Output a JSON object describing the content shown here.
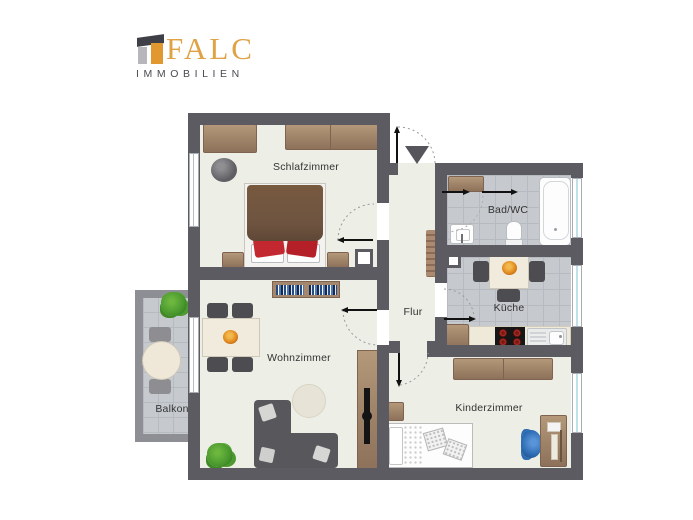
{
  "brand": {
    "name": "FALC",
    "subtitle": "IMMOBILIEN",
    "name_color": "#dfa245",
    "subtitle_color": "#4a4a52"
  },
  "rooms": {
    "schlafzimmer": {
      "label": "Schlafzimmer"
    },
    "badwc": {
      "label": "Bad/WC"
    },
    "kueche": {
      "label": "Küche"
    },
    "flur": {
      "label": "Flur"
    },
    "wohnzimmer": {
      "label": "Wohnzimmer"
    },
    "balkon": {
      "label": "Balkon"
    },
    "kinderzimmer": {
      "label": "Kinderzimmer"
    }
  },
  "icons": {
    "entrance_arrow": "entrance-direction-arrow",
    "door_swings": "dotted quarter-circle door swing arcs",
    "sliding_door_arrows": "sliding-door direction arrows"
  },
  "colors": {
    "wall": "#5b5b61",
    "balcony_wall": "#8e8f94",
    "room_floor": "#edeee5",
    "tile_floor": "#c6cace",
    "furniture_brown": "#b49879",
    "bed_duvet": "#6e5440",
    "accent_red": "#c32830",
    "sofa_gray": "#58585c",
    "desk_chair_blue": "#2d6cb3",
    "bowl_orange": "#e08b1f"
  }
}
